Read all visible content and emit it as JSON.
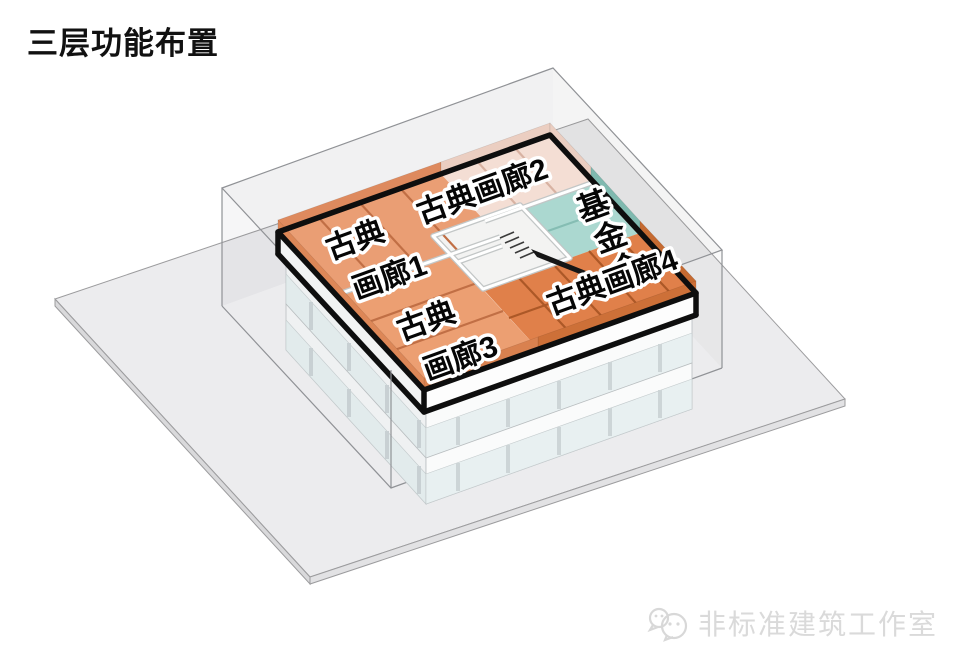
{
  "title": "三层功能布置",
  "watermark": {
    "icon": "wechat-bubbles-icon",
    "studio": "非标准建筑工作室"
  },
  "diagram": {
    "view": "axonometric-exploded-floor",
    "floor_shown": "三层",
    "rooms": [
      {
        "id": "classical-gallery-1",
        "label_line1": "古典",
        "label_line2": "画廊1",
        "floor_color": "#EA9E74",
        "wall_color": "#DE8A5E"
      },
      {
        "id": "classical-gallery-2",
        "label": "古典画廊2",
        "floor_color": "#F4DED4",
        "wall_color": "#EBCEC1"
      },
      {
        "id": "foundation",
        "chars": [
          "基",
          "金",
          "会"
        ],
        "floor_color": "#ABD8D0",
        "wall_color": "#7FB9AF"
      },
      {
        "id": "classical-gallery-3",
        "label_line1": "古典",
        "label_line2": "画廊3",
        "floor_color": "#EC9F72",
        "wall_color": "#D9814F"
      },
      {
        "id": "classical-gallery-4",
        "label": "古典画廊4",
        "floor_color": "#E0804A",
        "wall_color": "#C56A31"
      }
    ],
    "palette": {
      "floor_outline": "#0E0E0E",
      "wireframe_box": "#909296",
      "ground_top": "#ECECEE",
      "ground_side": "#D9D9DB",
      "slab_fascia": "#FDFDFD",
      "glazing": "#E6EEEF",
      "courtyard": "#F3F3F2"
    }
  }
}
